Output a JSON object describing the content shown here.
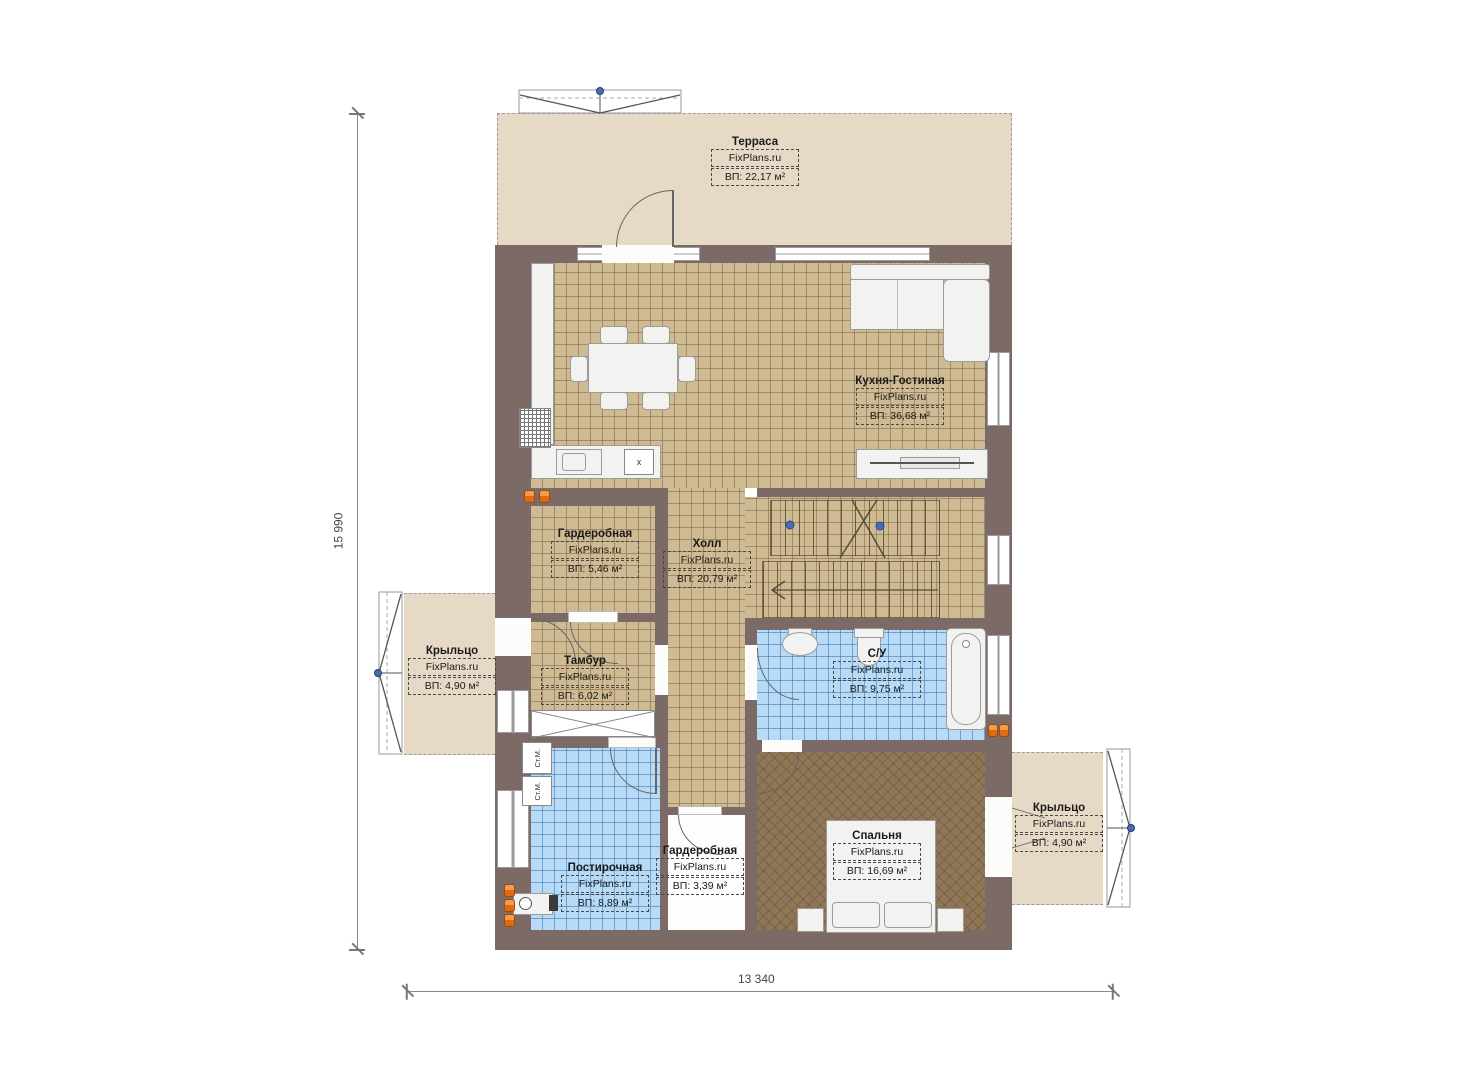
{
  "watermark": "FixPlans.ru",
  "dimensions": {
    "height_label": "15 990",
    "width_label": "13 340"
  },
  "labels": {
    "washer": "Ст.М.",
    "stove": "x"
  },
  "rooms": [
    {
      "id": "terrace",
      "name": "Терраса",
      "area": "ВП: 22,17 м²"
    },
    {
      "id": "kitchen-living",
      "name": "Кухня-Гостиная",
      "area": "ВП: 36,68 м²"
    },
    {
      "id": "wardrobe-1",
      "name": "Гардеробная",
      "area": "ВП: 5,46 м²"
    },
    {
      "id": "hall",
      "name": "Холл",
      "area": "ВП: 20,79 м²"
    },
    {
      "id": "porch-left",
      "name": "Крыльцо",
      "area": "ВП: 4,90 м²"
    },
    {
      "id": "vestibule",
      "name": "Тамбур",
      "area": "ВП: 6,02 м²"
    },
    {
      "id": "bathroom",
      "name": "С/У",
      "area": "ВП: 9,75 м²"
    },
    {
      "id": "laundry",
      "name": "Постирочная",
      "area": "ВП: 8,89 м²"
    },
    {
      "id": "wardrobe-2",
      "name": "Гардеробная",
      "area": "ВП: 3,39 м²"
    },
    {
      "id": "bedroom",
      "name": "Спальня",
      "area": "ВП: 16,69 м²"
    },
    {
      "id": "porch-right",
      "name": "Крыльцо",
      "area": "ВП: 4,90 м²"
    }
  ],
  "colors": {
    "wall": "#7c6a66",
    "tile_tan": "#cfbb93",
    "tile_blue": "#b7dbf6",
    "carpet_brown": "#8e7657",
    "deck_beige": "#e6dac7",
    "radiator": "#e8762a",
    "marker_blue": "#4a6cb3"
  }
}
